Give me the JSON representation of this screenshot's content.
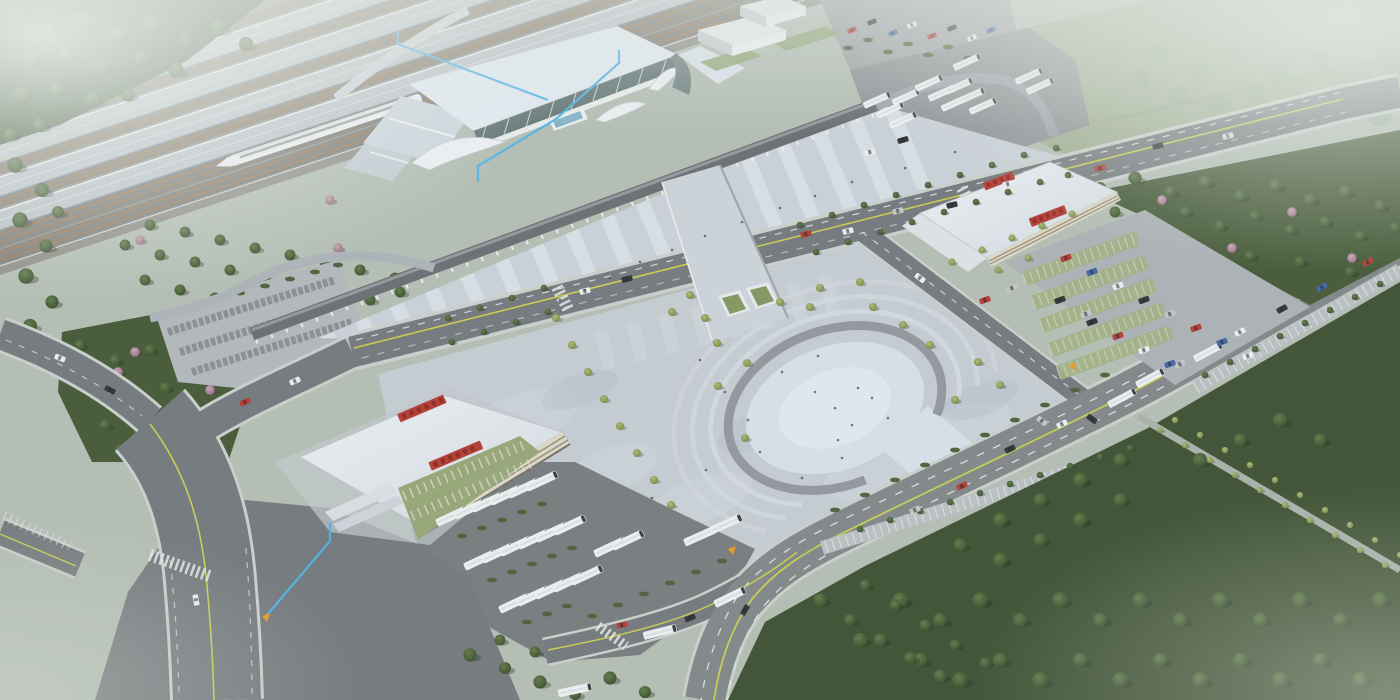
{
  "meta": {
    "title": "Railway station complex — aerial architectural rendering",
    "view": "oblique aerial 3D render, no visible UI text",
    "canvas": {
      "width": 1400,
      "height": 700
    }
  },
  "palette": {
    "base": "#b2bcb0",
    "fog": "#e6ece8",
    "field": "#9dab8d",
    "forest": "#35492a",
    "tree_light": "#7f9350",
    "blossom": "#9c7288",
    "hedge": "#44592f",
    "rail_bed": "#8b8881",
    "rail_rust": "#a4703f",
    "platform_canopy": "#b9c0c6",
    "train_white": "#eef1f2",
    "station_roof": "#e3eaf2",
    "station_glass": "#5d706e",
    "walkway": "#63676b",
    "deck": "#c9d0d7",
    "deck_stripe": "#dde3e9",
    "esplanade": "#c3cad1",
    "arch_ring": "#8d9298",
    "arch_fill": "#d7e0e9",
    "asphalt": "#6e7276",
    "highway": "#7c8184",
    "curb": "#c9cec9",
    "lane_yellow": "#c9cb49",
    "lane_white": "#e6e8e8",
    "building_white": "#e9edf1",
    "building_cream": "#ded6c3",
    "sign_red": "#b23227",
    "bus_white": "#eef1f2",
    "parking_green": "#9fae7e",
    "annotation_blue": "#45b1e8",
    "marker_orange": "#ef9413"
  },
  "scene": {
    "description": "High-speed railway station: rail yard with platform canopies and one bullet train (top left), main terminal hall with glass front and curved white entrance canopies, elevated drop-off walkway, striped forecourt deck, pedestrian bridge over the front road leading to a tree-dotted esplanade with a horseshoe-shaped sunken plaza, a bus terminal building (left) and a transit building (right) each with red rooftop signage, bus depots, car parks, tree belts and perimeter highways fading into haze at the corners.",
    "objects": [
      {
        "name": "rail-yard",
        "label": "platform canopies and tracks"
      },
      {
        "name": "bullet-train",
        "label": "white high-speed train"
      },
      {
        "name": "station-building",
        "label": "main terminal hall"
      },
      {
        "name": "auxiliary-buildings",
        "label": "white service boxes"
      },
      {
        "name": "dropoff-walkway",
        "label": "elevated drop-off road on columns"
      },
      {
        "name": "forecourt-deck",
        "label": "striped elevated forecourt"
      },
      {
        "name": "pedestrian-bridge",
        "label": "bridge with escalators"
      },
      {
        "name": "esplanade",
        "label": "paved plaza with small trees"
      },
      {
        "name": "arch-plaza",
        "label": "horseshoe-shaped sunken plaza"
      },
      {
        "name": "left-bus-terminal",
        "label": "bus terminal with red roof sign"
      },
      {
        "name": "right-transit-building",
        "label": "transit building with red roof signs"
      },
      {
        "name": "bus-depot-left",
        "label": "rows of parked white buses"
      },
      {
        "name": "bus-depot-topright",
        "label": "rows of parked white buses"
      },
      {
        "name": "car-park-right",
        "label": "car park with green stalls"
      },
      {
        "name": "car-park-northwest",
        "label": "empty striped car park"
      },
      {
        "name": "front-road",
        "label": "station front road"
      },
      {
        "name": "highway",
        "label": "perimeter highway"
      },
      {
        "name": "boulevard",
        "label": "west boulevard"
      },
      {
        "name": "forest-belts",
        "label": "perimeter tree masses"
      },
      {
        "name": "annotation-lines",
        "label": "blue callout lines"
      },
      {
        "name": "gate-markers",
        "label": "orange gate markers"
      }
    ]
  },
  "signage": {
    "left_terminal_roof_sign": "red characters (not legible at this scale)",
    "right_building_roof_signs": "red characters (not legible at this scale)"
  },
  "vehicles": {
    "train_count": 1,
    "bus_color": "#eef1f2",
    "car_colors": [
      "#b33226",
      "#3a5f9e",
      "#26282a",
      "#eef0f1",
      "#c0c4c8"
    ]
  }
}
